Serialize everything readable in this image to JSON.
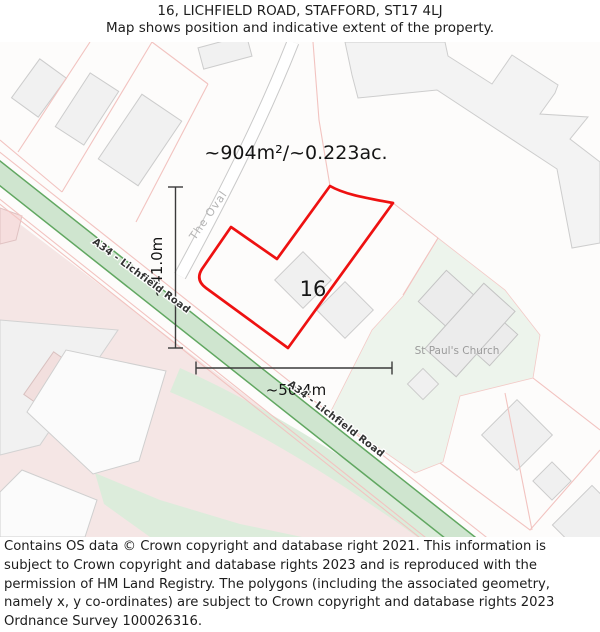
{
  "header": {
    "title": "16, LICHFIELD ROAD, STAFFORD, ST17 4LJ",
    "subtitle": "Map shows position and indicative extent of the property."
  },
  "map": {
    "area_label": "~904m²/~0.223ac.",
    "width_label": "~50.4m",
    "height_label": "~41.0m",
    "property_number": "16",
    "streets": {
      "the_oval": "The Oval",
      "a34": "A34 - Lichfield Road"
    },
    "poi": {
      "church": "St Paul's Church"
    },
    "colors": {
      "property_outline": "#ee1111",
      "road_fill": "#cfe5cf",
      "road_casing": "#61a761",
      "residential_area": "#f5e6e5",
      "green_space": "#edf4ec",
      "building": "#f1f1f1"
    }
  },
  "footer": {
    "attribution": "Contains OS data © Crown copyright and database right 2021. This information is subject to Crown copyright and database rights 2023 and is reproduced with the permission of HM Land Registry. The polygons (including the associated geometry, namely x, y co-ordinates) are subject to Crown copyright and database rights 2023 Ordnance Survey 100026316."
  }
}
